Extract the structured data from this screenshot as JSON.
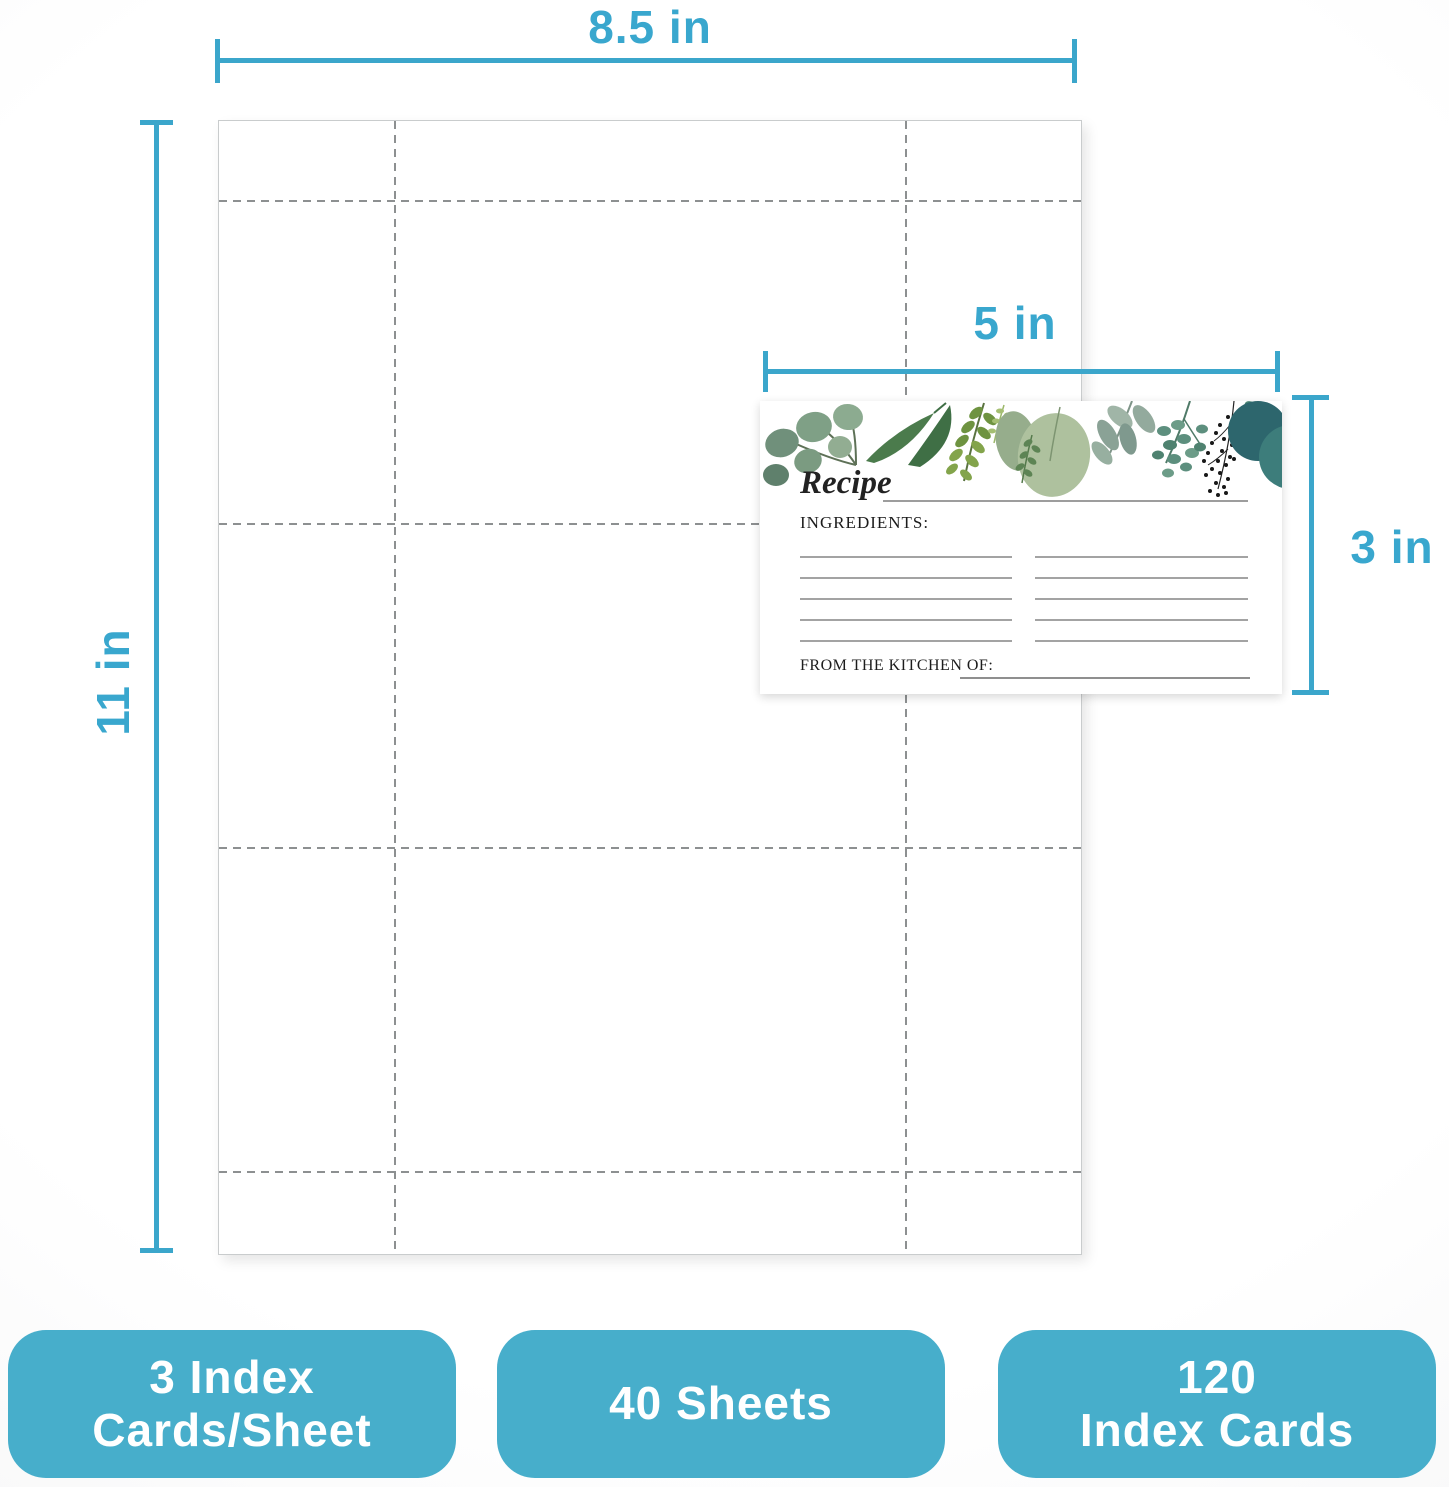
{
  "dimension_labels": {
    "sheet_width": "8.5 in",
    "sheet_height": "11 in",
    "card_width": "5 in",
    "card_height": "3 in"
  },
  "sheet": {
    "description": "letter sheet with perforation guides",
    "dashed_columns": 2,
    "dashed_rows": 4,
    "cards_per_sheet": 3
  },
  "recipe_card": {
    "title": "Recipe",
    "ingredients_label": "INGREDIENTS:",
    "from_kitchen_label": "FROM THE KITCHEN OF:",
    "ingredient_line_count_left": 5,
    "ingredient_line_count_right": 5
  },
  "badges": [
    {
      "lines": [
        "3 Index",
        "Cards/Sheet"
      ]
    },
    {
      "lines": [
        "40 Sheets"
      ]
    },
    {
      "lines": [
        "120",
        "Index Cards"
      ]
    }
  ],
  "colors": {
    "accent_line": "#3ba6cb",
    "accent_text": "#39a7ce",
    "badge_fill": "#47aecb",
    "dash_gray": "#8d9091",
    "card_rule_gray": "#a3a3a3"
  }
}
